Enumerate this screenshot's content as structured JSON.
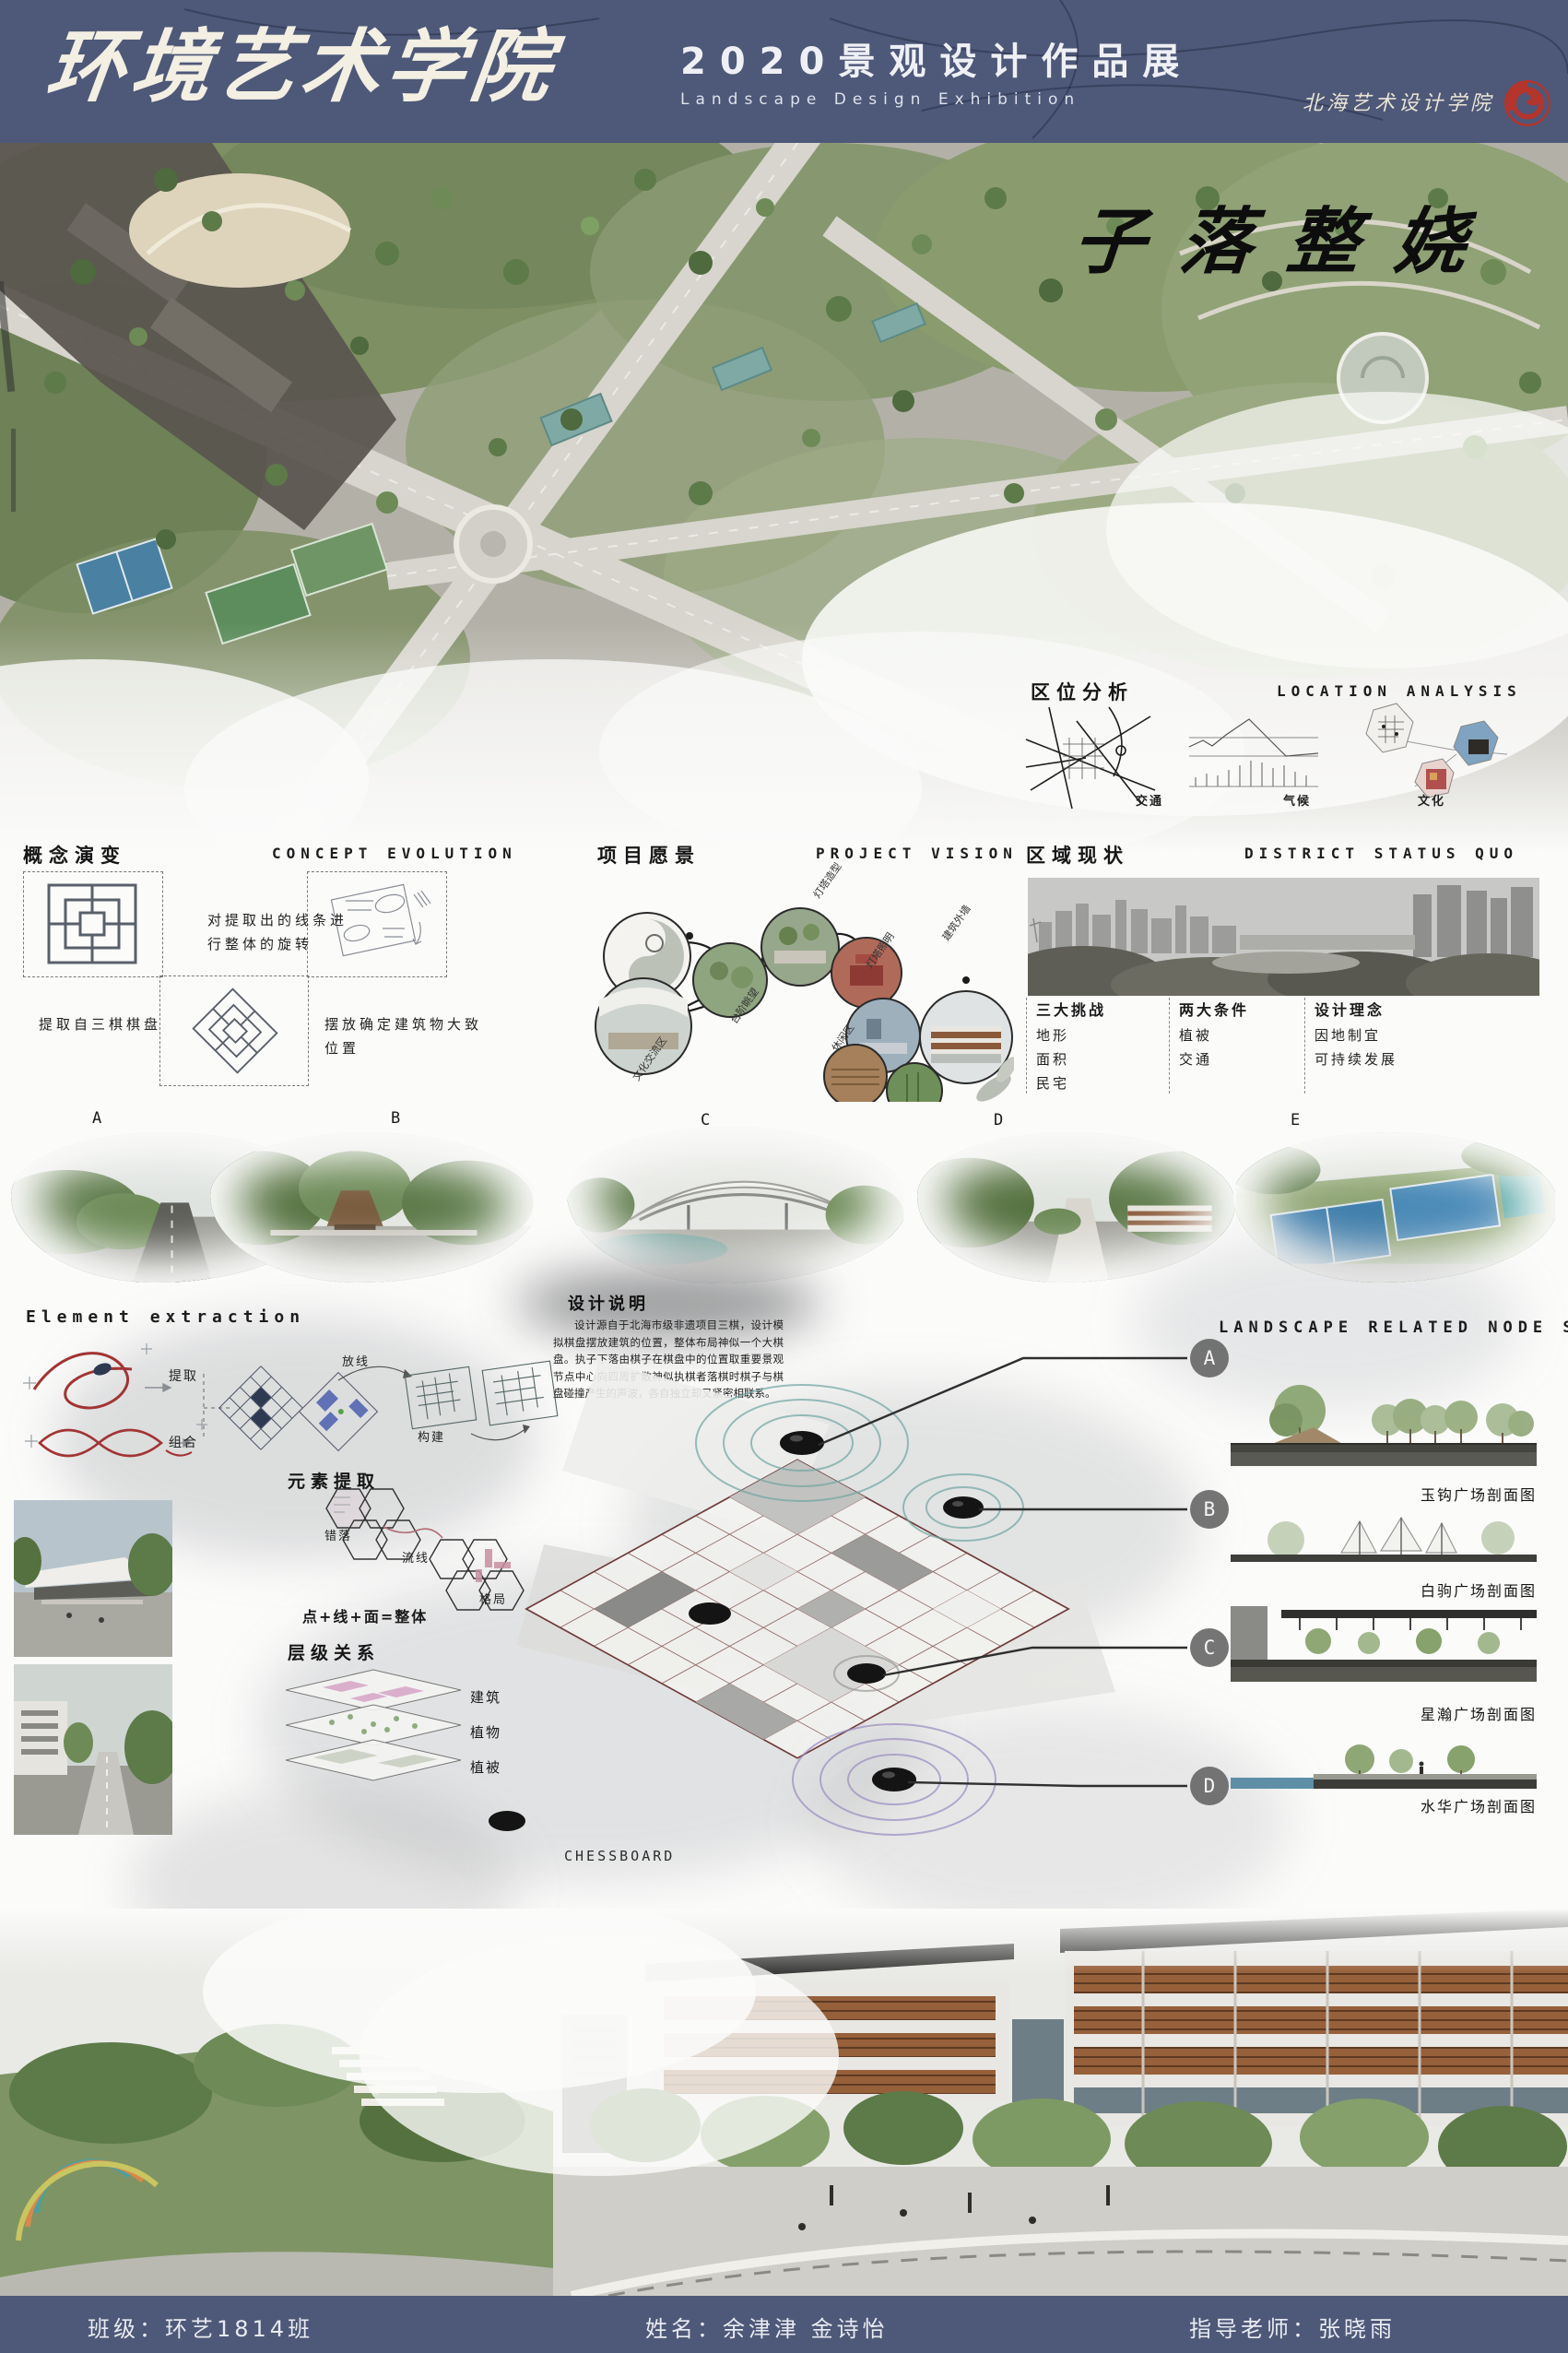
{
  "header": {
    "school_name": "环境艺术学院",
    "exhibition_title_zh": "2020景观设计作品展",
    "exhibition_title_en": "Landscape Design Exhibition",
    "institute_name": "北海艺术设计学院"
  },
  "artwork_title": "子落整娆",
  "location_analysis": {
    "title_zh": "区位分析",
    "title_en": "LOCATION ANALYSIS",
    "items": [
      "交通",
      "气候",
      "文化"
    ]
  },
  "concept_evolution": {
    "title_zh": "概念演变",
    "title_en": "CONCEPT EVOLUTION",
    "caption_source": "提取自三棋棋盘",
    "caption_rotate": "对提取出的线条进行整体的旋转",
    "caption_place": "摆放确定建筑物大致位置"
  },
  "project_vision": {
    "title_zh": "项目愿景",
    "title_en": "PROJECT VISION",
    "labels": [
      "灯塔造型",
      "灯塔照明",
      "建筑外墙",
      "台阶眺望",
      "休闲区",
      "文化交流区"
    ]
  },
  "district_status": {
    "title_zh": "区域现状",
    "title_en": "DISTRICT STATUS QUO",
    "columns": [
      {
        "title": "三大挑战",
        "items": [
          "地形",
          "面积",
          "民宅"
        ]
      },
      {
        "title": "两大条件",
        "items": [
          "植被",
          "交通"
        ]
      },
      {
        "title": "设计理念",
        "items": [
          "因地制宜",
          "可持续发展"
        ]
      }
    ]
  },
  "perspectives": {
    "labels": [
      "A",
      "B",
      "C",
      "D",
      "E"
    ]
  },
  "element_extraction": {
    "title_en": "Element extraction",
    "label_extract": "提取",
    "label_combine": "组合",
    "label_setout": "放线",
    "label_construct": "构建"
  },
  "element_refine": {
    "title_zh": "元素提取",
    "hex_labels": [
      "错落",
      "流线",
      "格局"
    ],
    "formula": "点+线+面=整体"
  },
  "hierarchy": {
    "title_zh": "层级关系",
    "layers": [
      "建筑",
      "植物",
      "植被"
    ]
  },
  "design_note": {
    "title_zh": "设计说明",
    "body": "设计源自于北海市级非遗项目三棋，设计模拟棋盘摆放建筑的位置，整体布局神似一个大棋盘。执子下落由棋子在棋盘中的位置取重要景观节点中心向四周扩散神似执棋者落棋时棋子与棋盘碰撞产生的声波，各自独立却又紧密相联系。"
  },
  "node_sections": {
    "title_en": "LANDSCAPE RELATED NODE SECTION",
    "sections": [
      {
        "marker": "A",
        "label": "玉钩广场剖面图"
      },
      {
        "marker": "B",
        "label": "白驹广场剖面图"
      },
      {
        "marker": "C",
        "label": "星瀚广场剖面图"
      },
      {
        "marker": "D",
        "label": "水华广场剖面图"
      }
    ]
  },
  "chessboard_label": "CHESSBOARD",
  "footer": {
    "class_name": "班级：环艺1814班",
    "students": "姓名：余津津 金诗怡",
    "advisor": "指导老师：张晓雨"
  },
  "colors": {
    "banner_bg": "#4e5878",
    "logo_red": "#b5342c",
    "ink": "#1c1c1c"
  }
}
